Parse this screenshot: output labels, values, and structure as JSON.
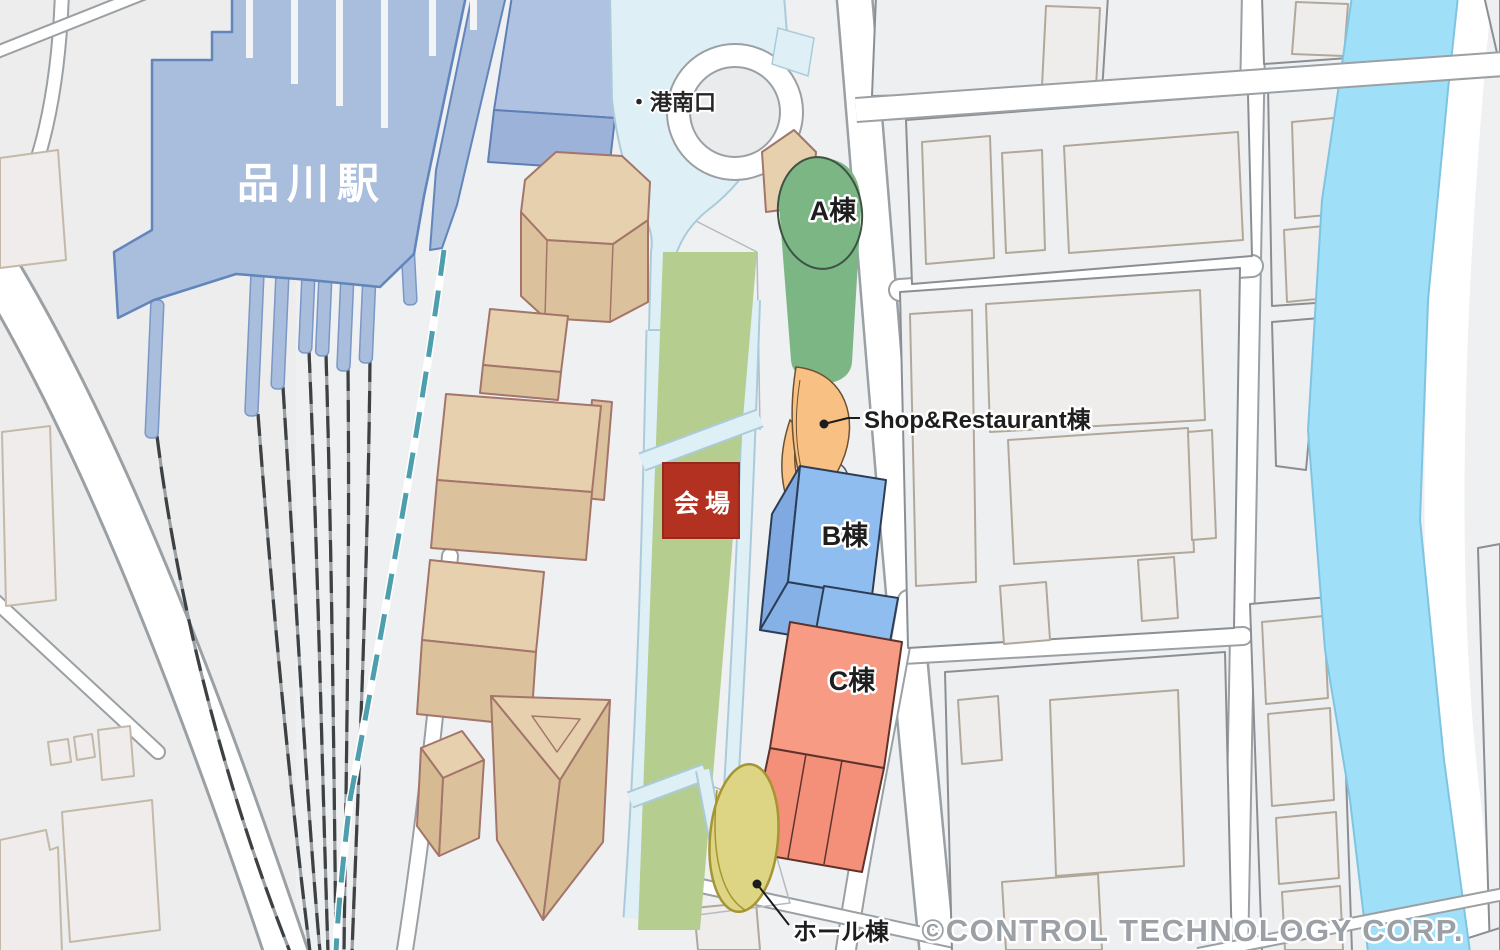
{
  "map": {
    "labels": {
      "station": "品川駅",
      "exit": "・港南口",
      "venue": "会場",
      "building_a": "A棟",
      "shop_restaurant": "Shop&Restaurant棟",
      "building_b": "B棟",
      "building_c": "C棟",
      "hall": "ホール棟"
    },
    "copyright": "©CONTROL TECHNOLOGY CORP.",
    "colors": {
      "background": "#eef0f2",
      "road_white": "#ffffff",
      "block_fill": "#edeff1",
      "station_fill": "#a9bddc",
      "deck_fill": "#def0f6",
      "park_fill": "#b6cd90",
      "venue_red": "#b23120",
      "building_a_green": "#7cb685",
      "shop_orange": "#f9c083",
      "building_b_blue": "#90bdef",
      "building_c_salmon": "#f79b85",
      "hall_yellow": "#ded584",
      "tan_building_top": "#e6d0ad",
      "tan_building_side": "#dcc29c",
      "river_blue": "#9fdff8",
      "shinkansen_teal": "#4e9fae"
    }
  }
}
